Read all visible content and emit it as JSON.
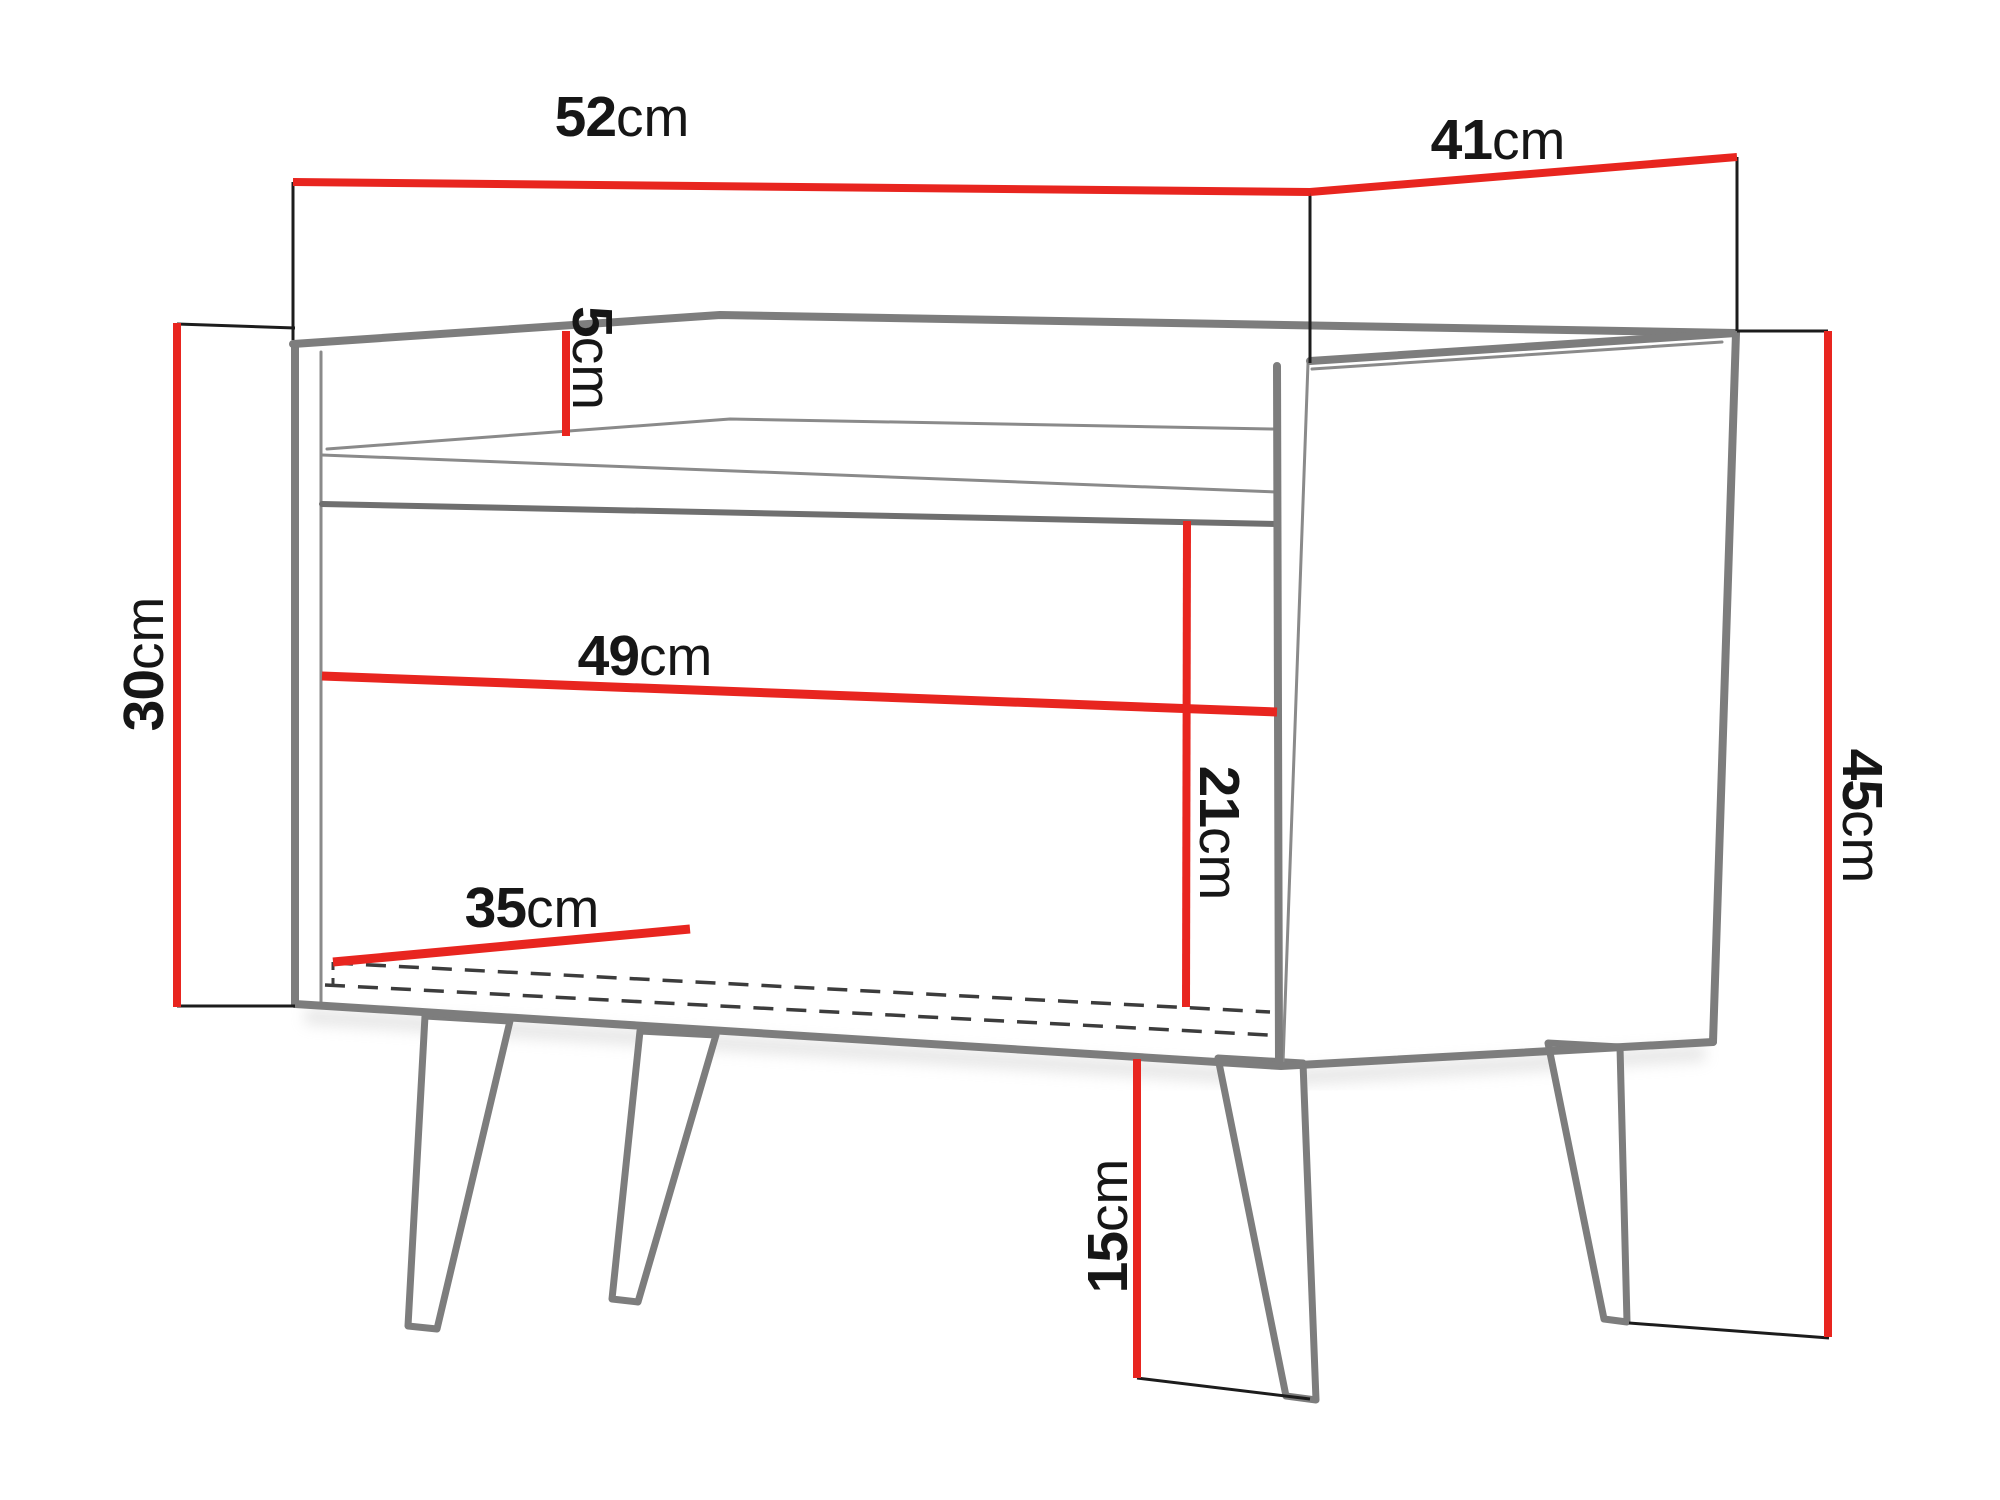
{
  "diagram": {
    "type": "furniture-dimension-drawing",
    "subject": "bedside cabinet with open shelf on four splayed legs"
  },
  "colors": {
    "red": "#e8251f",
    "outline": "#7d7d7d",
    "ink": "#161616"
  },
  "dimensions": {
    "top_width": {
      "value": "52",
      "unit": "cm"
    },
    "top_depth": {
      "value": "41",
      "unit": "cm"
    },
    "rim_height": {
      "value": "5",
      "unit": "cm"
    },
    "body_height": {
      "value": "30",
      "unit": "cm"
    },
    "total_height": {
      "value": "45",
      "unit": "cm"
    },
    "inner_width": {
      "value": "49",
      "unit": "cm"
    },
    "inner_height": {
      "value": "21",
      "unit": "cm"
    },
    "inner_depth": {
      "value": "35",
      "unit": "cm"
    },
    "leg_height": {
      "value": "15",
      "unit": "cm"
    }
  }
}
